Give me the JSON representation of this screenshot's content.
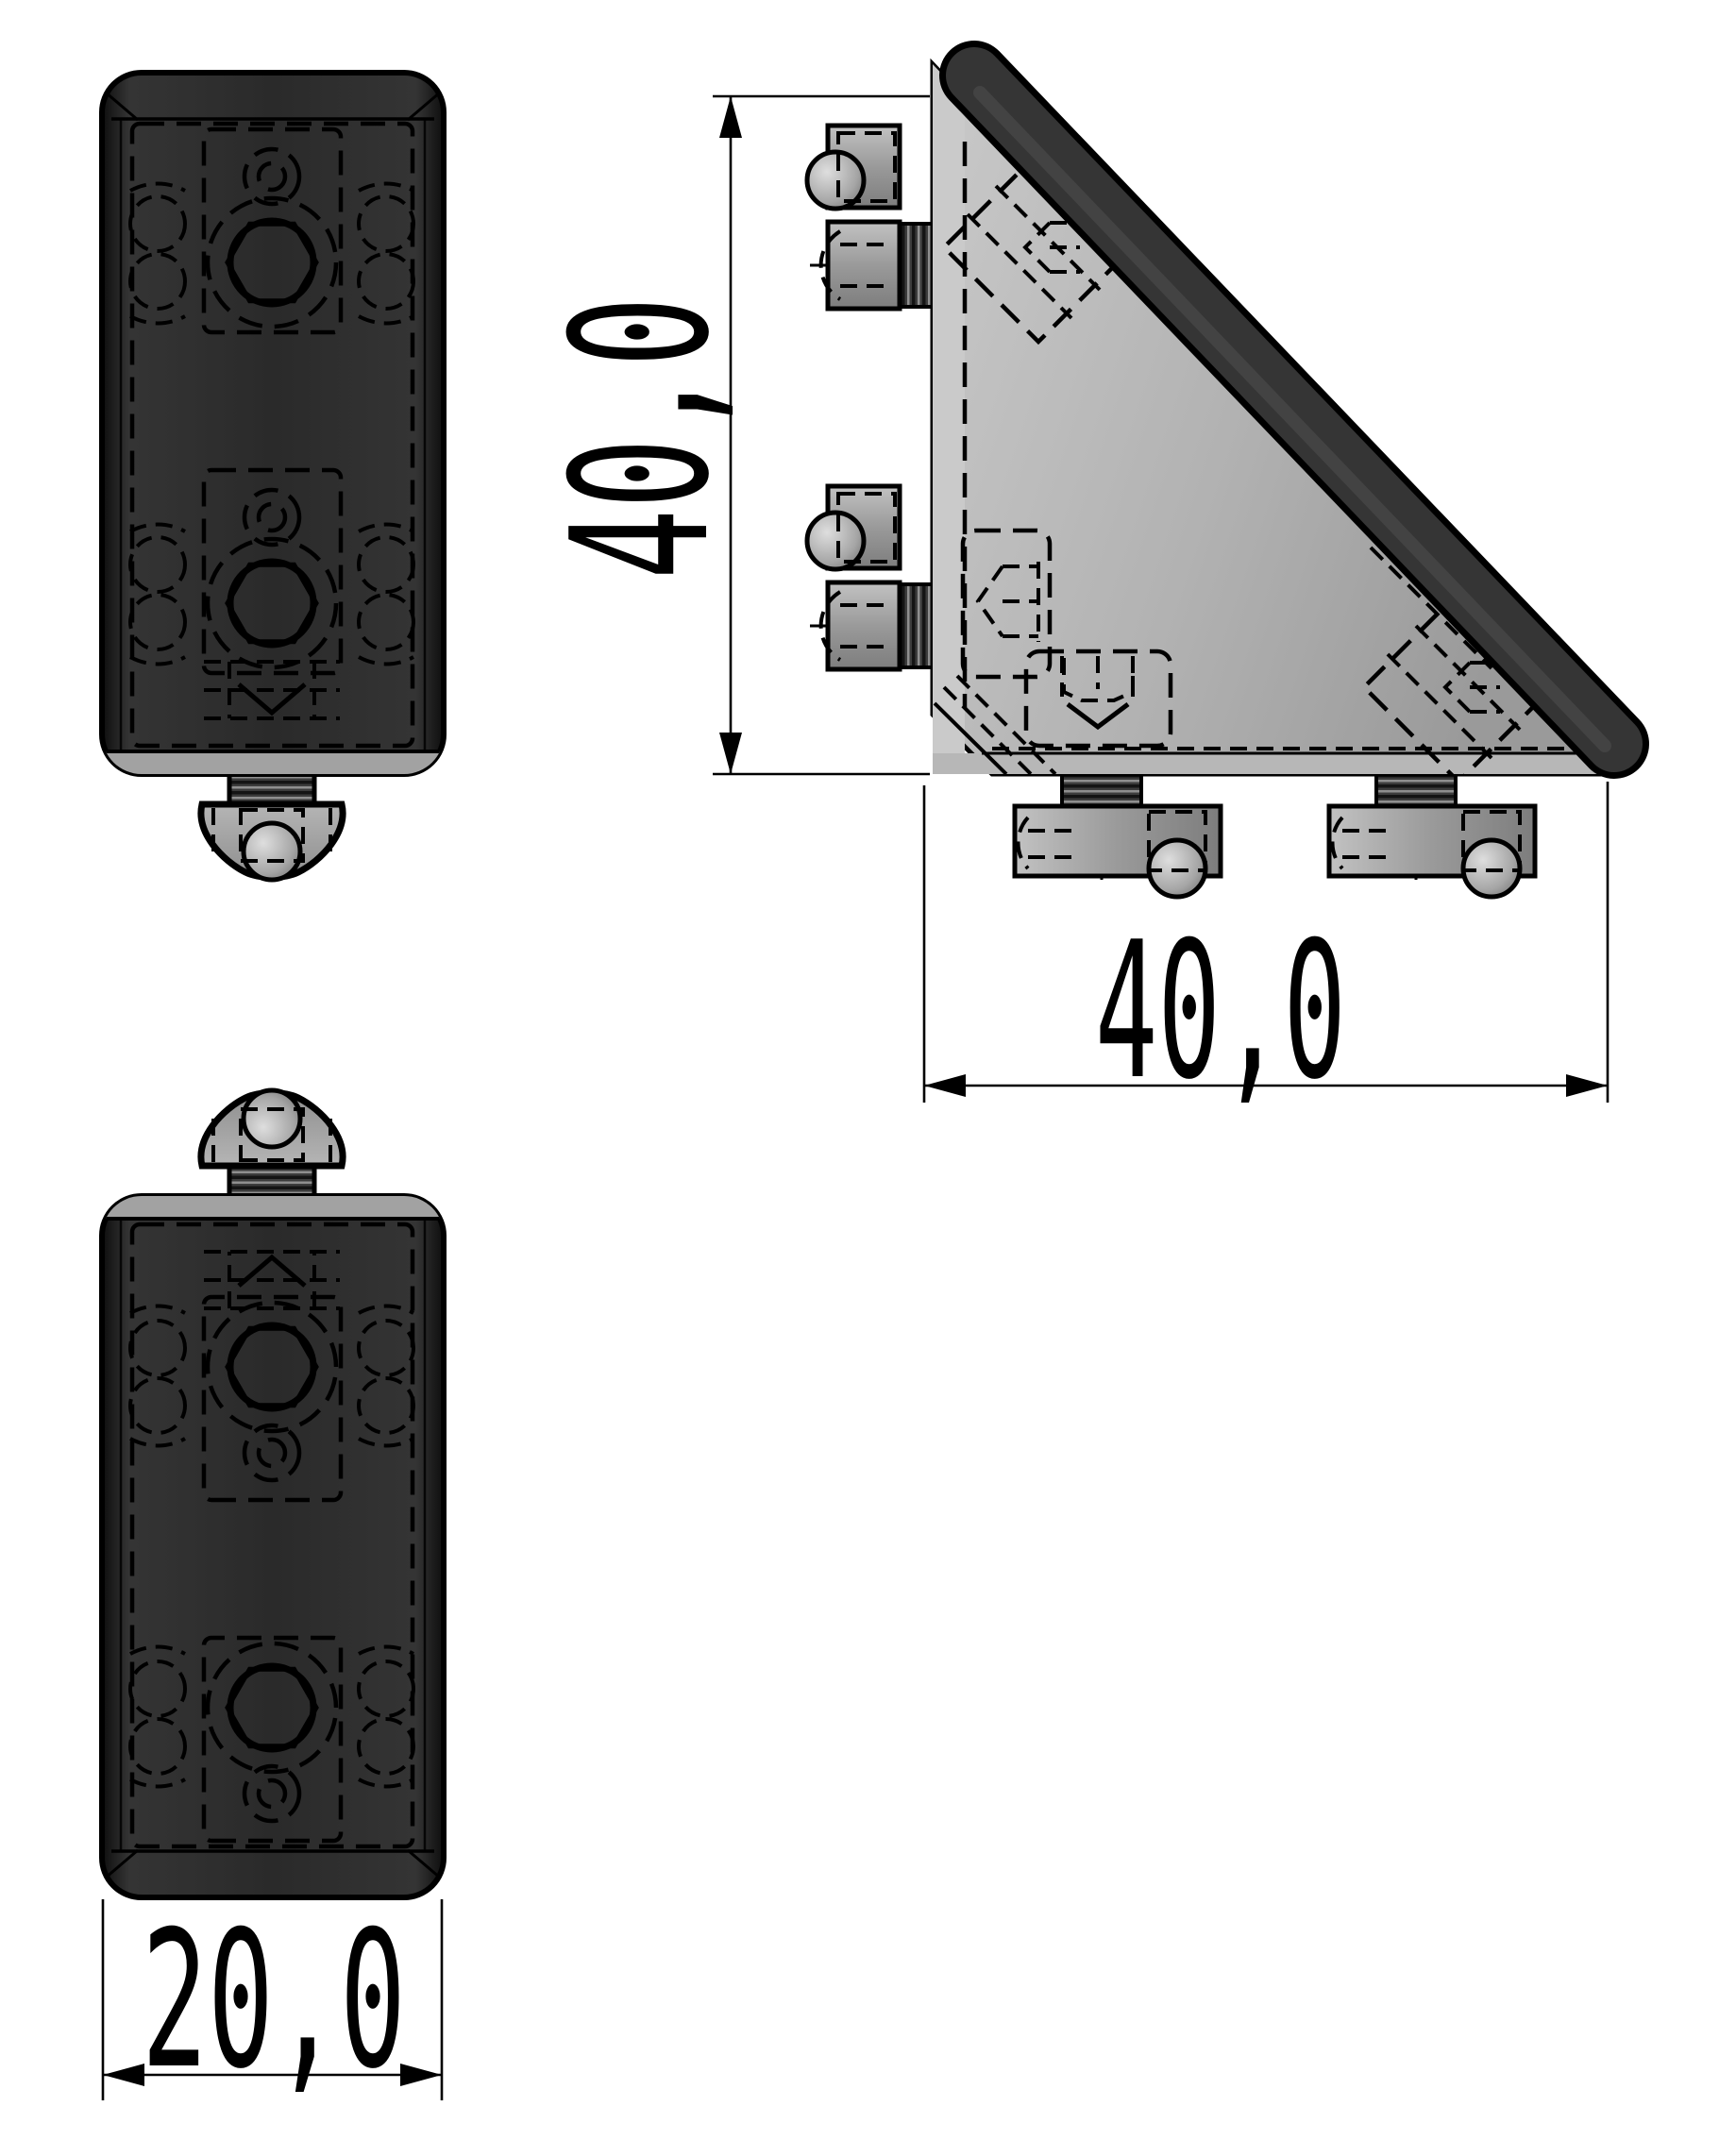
{
  "drawing": {
    "title": "angle bracket 40x40x20 three-view technical drawing",
    "views": {
      "top_view": "bracket top view with t-slot tab",
      "side_view": "triangular gusset side view with fastening sets",
      "bottom_view": "bracket bottom view with t-slot tab"
    },
    "dimensions": {
      "height": {
        "value": "40,0"
      },
      "width": {
        "value": "40,0"
      },
      "depth": {
        "value": "20,0"
      }
    },
    "colors": {
      "background": "#ffffff",
      "body_black": "#2b2b2b",
      "face_gray": "#b4b4b4",
      "cap_dark": "#333333",
      "metal_gray": "#9c9c9c",
      "line_black": "#000000"
    }
  }
}
